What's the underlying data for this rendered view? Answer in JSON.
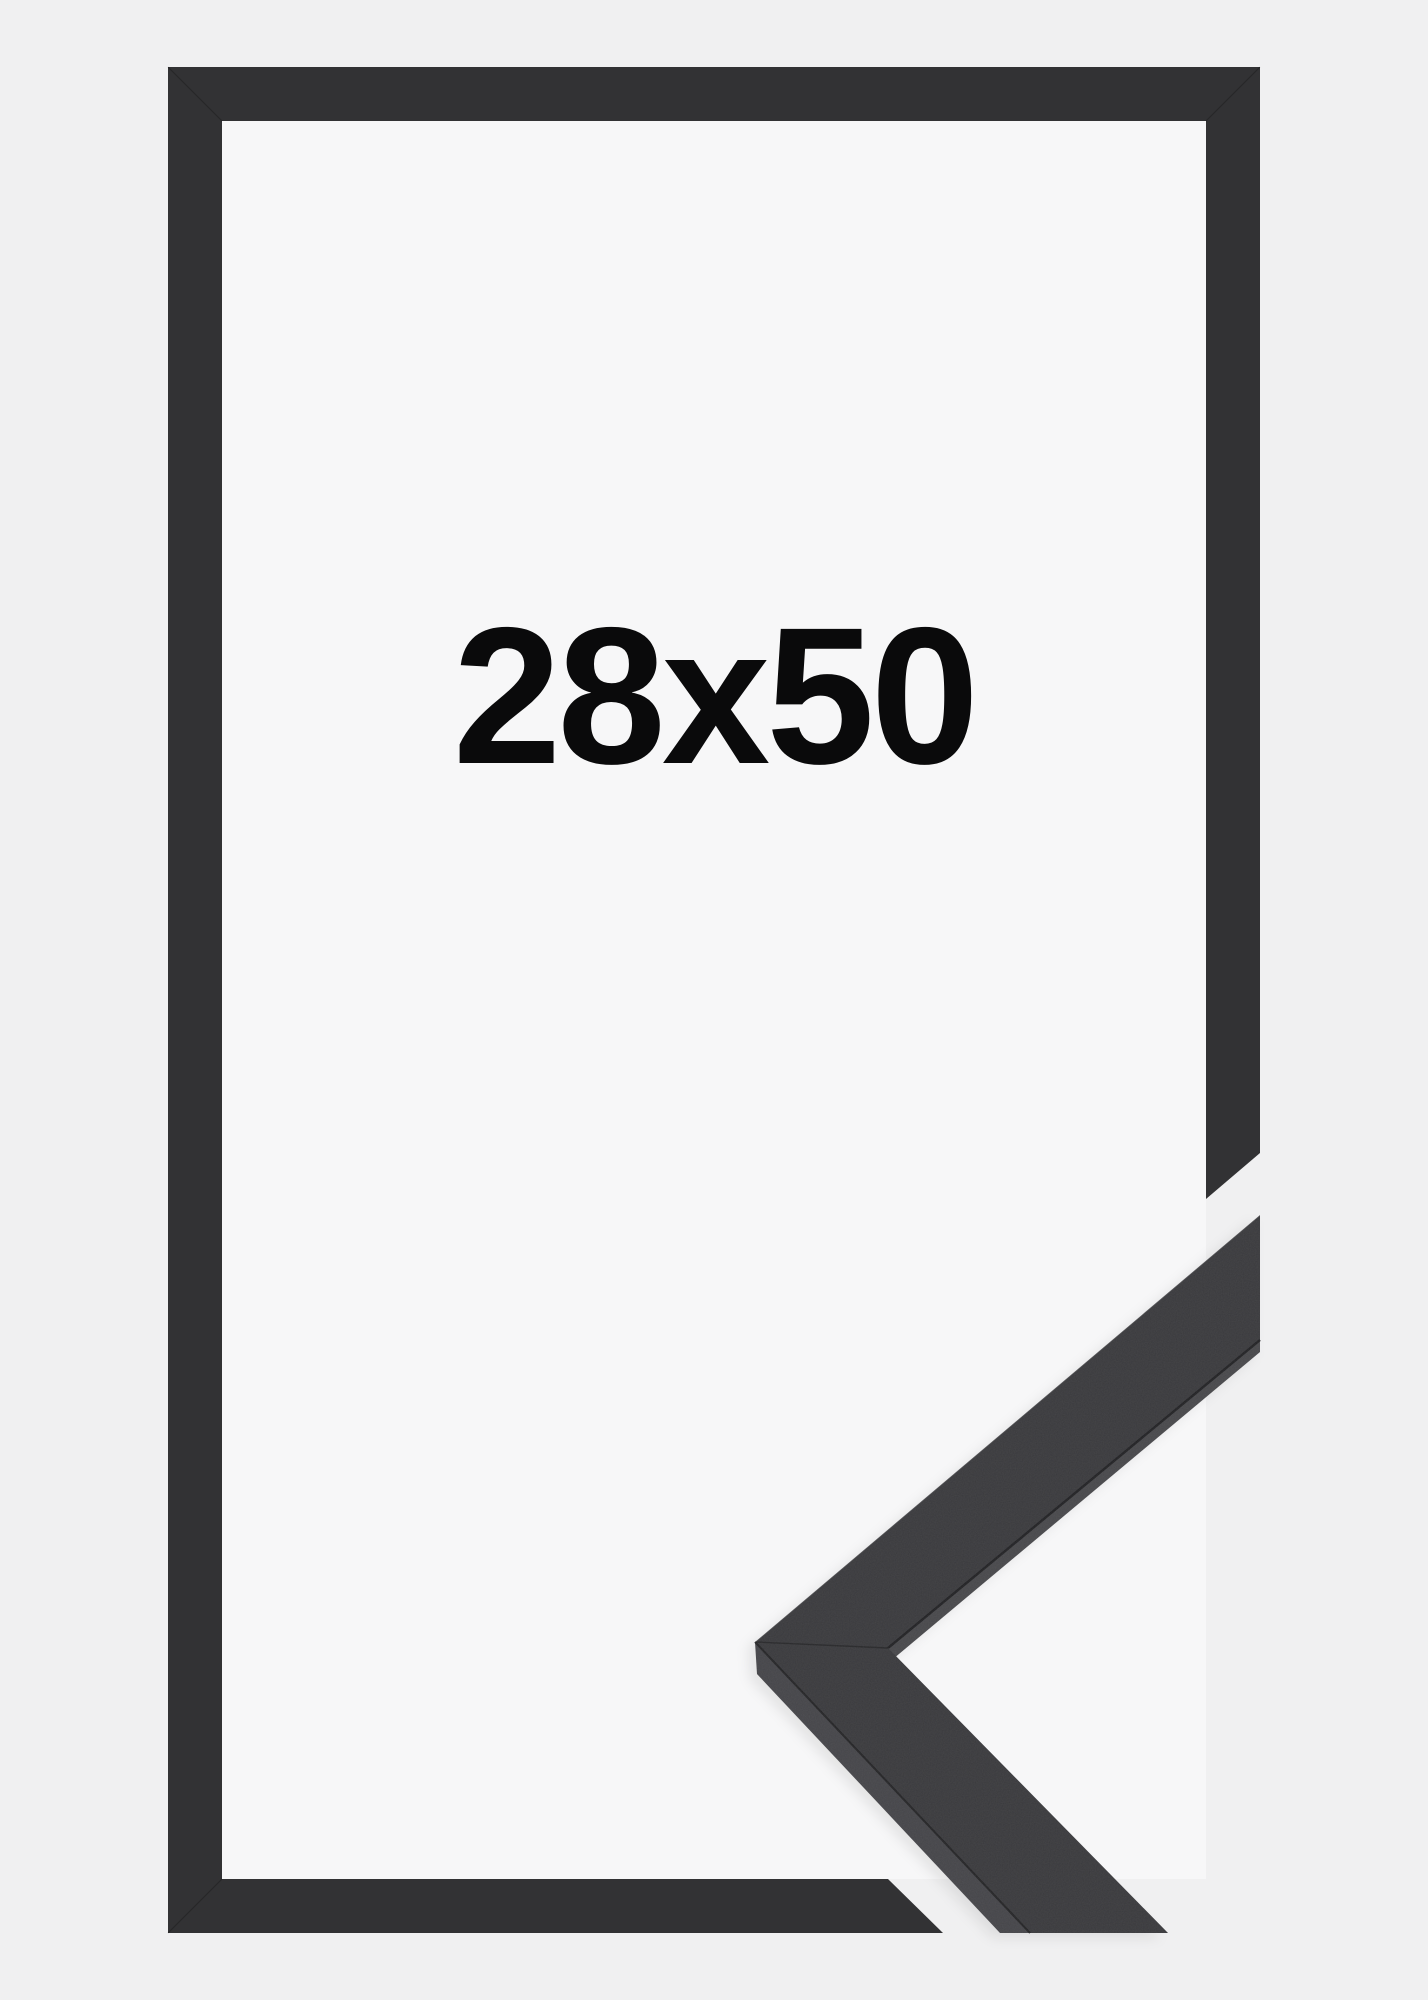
{
  "product": {
    "size_label": "28x50",
    "colors": {
      "canvas_bg": "#f0f0f1",
      "frame_interior": "#f7f7f8",
      "frame_moulding": "#323234",
      "piece_front": "#3a3a3d",
      "piece_side_lower": "#454549",
      "piece_side_inner": "#48484b",
      "seam": "#1e1e20",
      "label_text": "#0a0a0b"
    }
  }
}
